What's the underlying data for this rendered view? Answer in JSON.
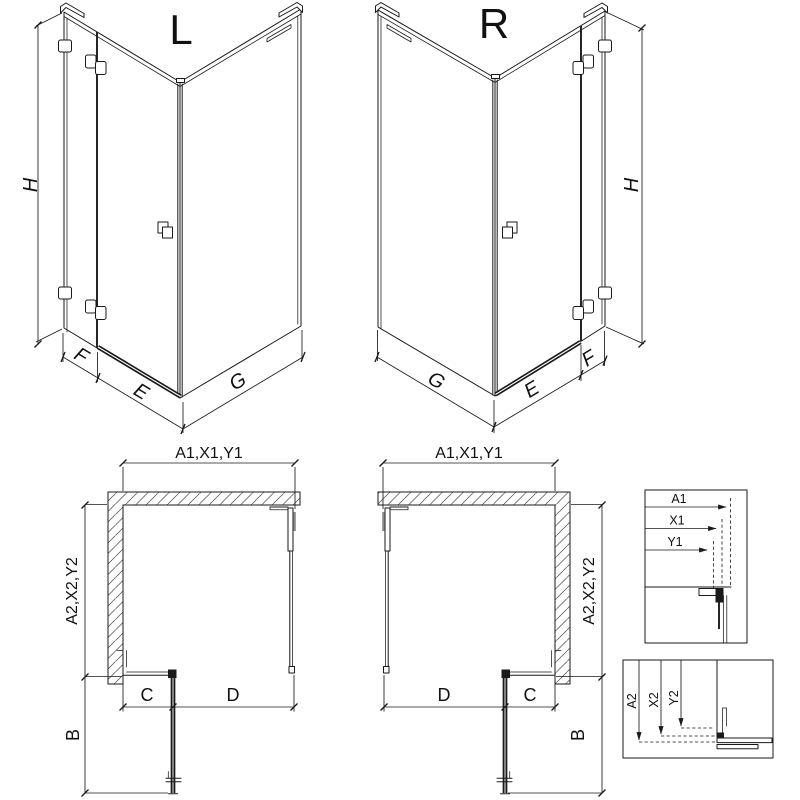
{
  "page": {
    "background": "#ffffff",
    "line_color": "#1a1a1a"
  },
  "iso_left": {
    "title": "L",
    "dim_height": "H",
    "dim_fixed_panel": "F",
    "dim_door": "E",
    "dim_side_panel": "G"
  },
  "iso_right": {
    "title": "R",
    "dim_height": "H",
    "dim_fixed_panel": "F",
    "dim_door": "E",
    "dim_side_panel": "G"
  },
  "plan_left": {
    "dim_top_chain": "A1,X1,Y1",
    "dim_side_chain": "A2,X2,Y2",
    "dim_c": "C",
    "dim_d": "D",
    "dim_b": "B"
  },
  "plan_right": {
    "dim_top_chain": "A1,X1,Y1",
    "dim_side_chain": "A2,X2,Y2",
    "dim_c": "C",
    "dim_d": "D",
    "dim_b": "B"
  },
  "detail_horizontal": {
    "dim_a1": "A1",
    "dim_x1": "X1",
    "dim_y1": "Y1"
  },
  "detail_vertical": {
    "dim_a2": "A2",
    "dim_x2": "X2",
    "dim_y2": "Y2"
  }
}
